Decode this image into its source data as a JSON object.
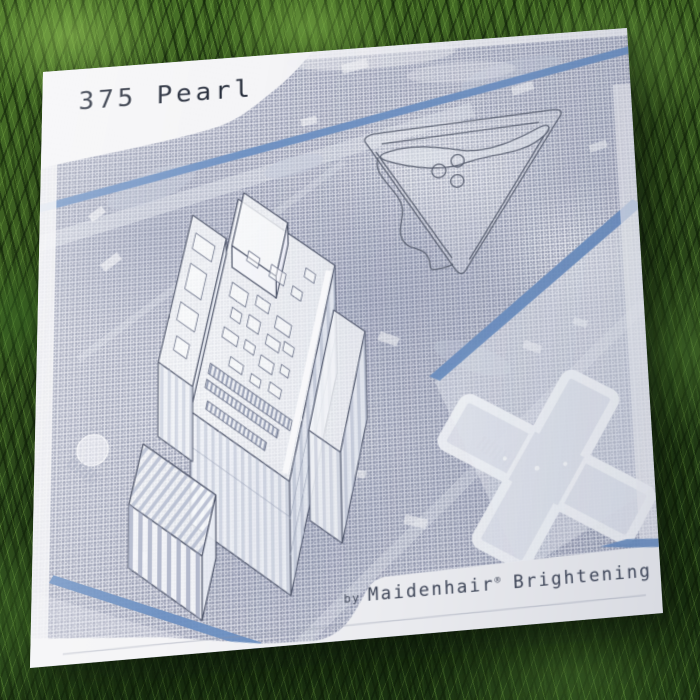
{
  "album": {
    "title": "375 Pearl",
    "credit": {
      "by": "by",
      "artist": "Maidenhair",
      "registered_mark": "®",
      "artist_suffix": "Brightening"
    }
  },
  "artwork": {
    "elements": {
      "map": "halftone aerial map print",
      "building": "axonometric line drawing of tower",
      "triangle": "rounded triangular park outline with three circles",
      "cross": "cruciform building footprint",
      "accents": "four steel-blue diagonal lines"
    },
    "colors": {
      "accent_blue": "#6a8fc2",
      "ink_navy": "#1d2433",
      "credit_gray": "#3c4354",
      "paper_white": "#f5f5f7",
      "map_tone": "#d9dbe5",
      "outline_gray": "#4a5166"
    }
  },
  "scene": {
    "setting": "album cover lying on grass",
    "grass_dark": "#1a3211",
    "grass_light": "#5d8c33"
  }
}
